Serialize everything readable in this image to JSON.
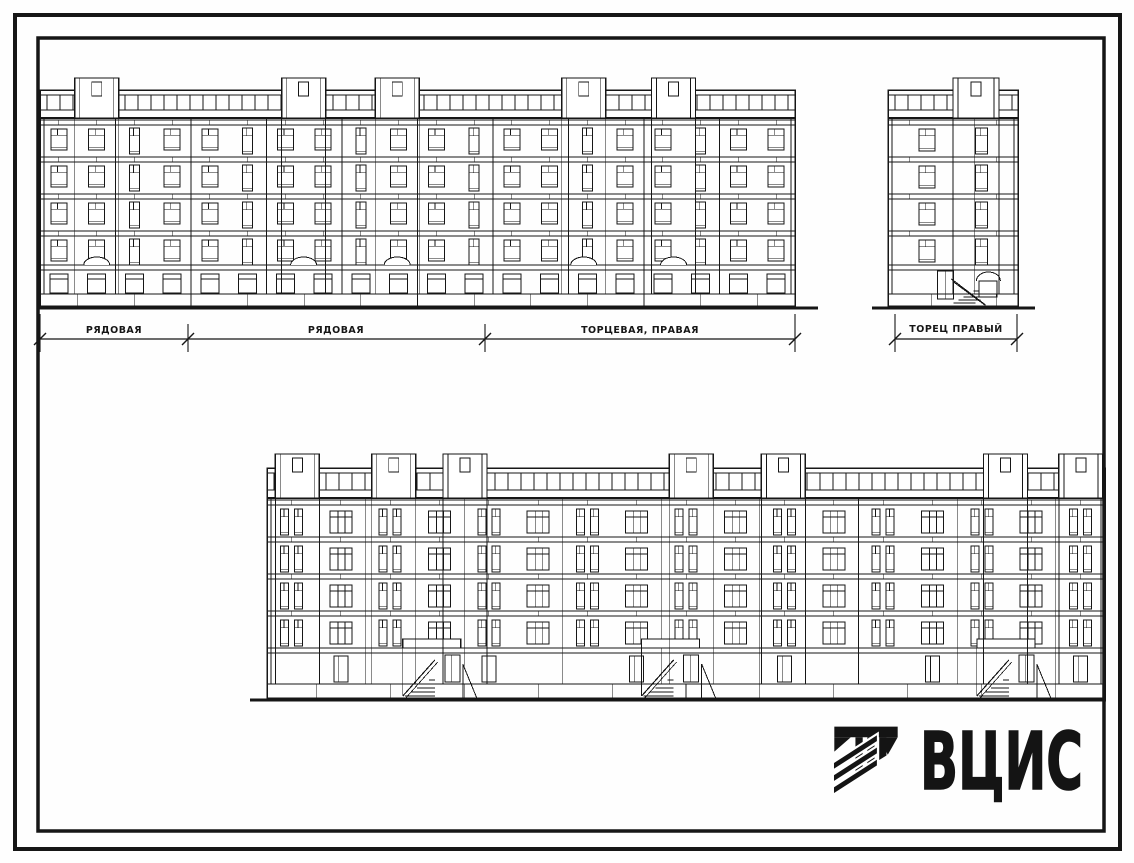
{
  "colors": {
    "ink": "#161616",
    "paper": "#ffffff"
  },
  "dimension_labels": {
    "segment1": "РЯДОВАЯ",
    "segment2": "РЯДОВАЯ",
    "segment3": "ТОРЦЕВАЯ, ПРАВАЯ",
    "end": "ТОРЕЦ ПРАВЫЙ"
  },
  "logo": {
    "text": "ВЦИС",
    "icon": "vcis-emblem-icon"
  },
  "elevations": {
    "main": {
      "x": 40,
      "w": 755,
      "roofY": 90,
      "roofBandH": 28,
      "floorTop": 120,
      "floorH": 37,
      "floors": 4,
      "groundTop": 265,
      "baseTop": 294,
      "groundY": 306,
      "cols": 20,
      "style": "front",
      "towers": [
        0.046,
        0.32,
        0.444,
        0.691,
        0.81
      ],
      "towerW": 44,
      "towerRise": 12,
      "groundLine": [
        37,
        818
      ]
    },
    "end": {
      "x": 888,
      "w": 130,
      "roofY": 90,
      "roofBandH": 28,
      "floorTop": 120,
      "floorH": 37,
      "floors": 4,
      "groundTop": 265,
      "baseTop": 294,
      "groundY": 306,
      "cols": 3,
      "style": "end",
      "towers": [
        0.5
      ],
      "towerW": 46,
      "towerRise": 12,
      "groundLine": [
        872,
        1035
      ]
    },
    "rear": {
      "x": 267,
      "w": 838,
      "roofY": 468,
      "roofBandH": 30,
      "floorTop": 500,
      "floorH": 37,
      "floors": 4,
      "groundTop": 648,
      "baseTop": 684,
      "groundY": 698,
      "cols": 17,
      "style": "rear",
      "towers": [
        0.01,
        0.125,
        0.21,
        0.48,
        0.59,
        0.855,
        0.945
      ],
      "towerW": 44,
      "towerRise": 14,
      "entrances": [
        0.205,
        0.49,
        0.89
      ],
      "groundLine": [
        250,
        1106
      ]
    }
  }
}
